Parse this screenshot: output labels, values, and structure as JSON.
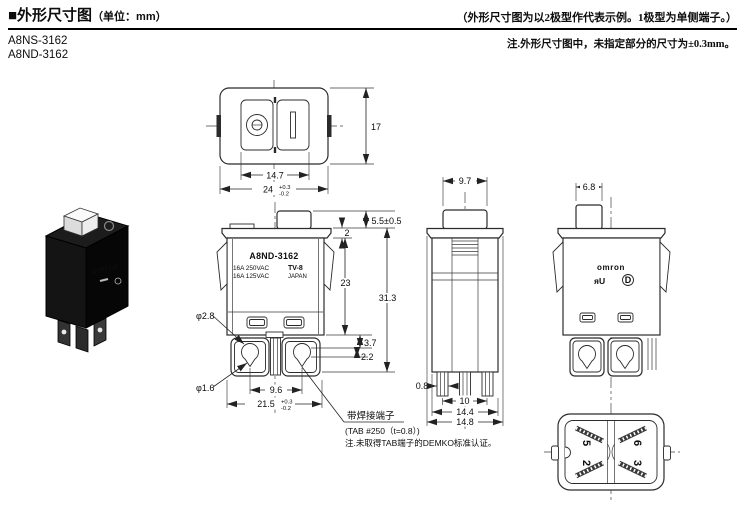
{
  "header": {
    "title": "■外形尺寸图",
    "unit": "（单位：mm）",
    "representative_note": "（外形尺寸图为以2极型作代表示例。1极型为单侧端子。）",
    "tolerance_note": "注.外形尺寸图中，未指定部分的尺寸为±0.3mm。"
  },
  "models": {
    "model1": "A8NS-3162",
    "model2": "A8ND-3162"
  },
  "photo": {
    "brand": "omron"
  },
  "top_view": {
    "rocker_width": "14.7",
    "overall_width": "24",
    "overall_width_tol_plus": "+0.3",
    "overall_width_tol_minus": "-0.2",
    "depth": "17"
  },
  "front_view": {
    "marking_model": "A8ND-3162",
    "marking_rating_250": "16A 250VAC",
    "marking_rating_125": "16A 125VAC",
    "marking_tv_rating": "TV-8",
    "marking_origin": "JAPAN",
    "rocker_protrusion": "5.5±0.5",
    "flange_thickness": "2",
    "body_height": "23",
    "overall_height": "31.3",
    "hole_large": "φ2.8",
    "hole_small": "φ1.6",
    "terminal_offset": "3.7",
    "terminal_tip": "2.2",
    "terminal_pitch": "9.6",
    "body_width": "21.5",
    "body_width_tol_plus": "+0.3",
    "body_width_tol_minus": "-0.2"
  },
  "side_view_a": {
    "rocker_width": "9.7",
    "terminal_thickness": "0.8",
    "terminal_pitch": "10",
    "body_depth": "14.4",
    "flange_depth": "14.8"
  },
  "side_view_b": {
    "rocker_depth": "6.8",
    "brand": "omron",
    "ul_mark": "ᴙU",
    "demko_mark": "D"
  },
  "bottom_view": {
    "terminal_5": "5",
    "terminal_6": "6",
    "terminal_2": "2",
    "terminal_3": "3"
  },
  "callout": {
    "line1": "带焊接端子",
    "line2": "(TAB #250（t=0.8）)",
    "line3": "注.未取得TAB端子的DEMKO标准认证。"
  }
}
